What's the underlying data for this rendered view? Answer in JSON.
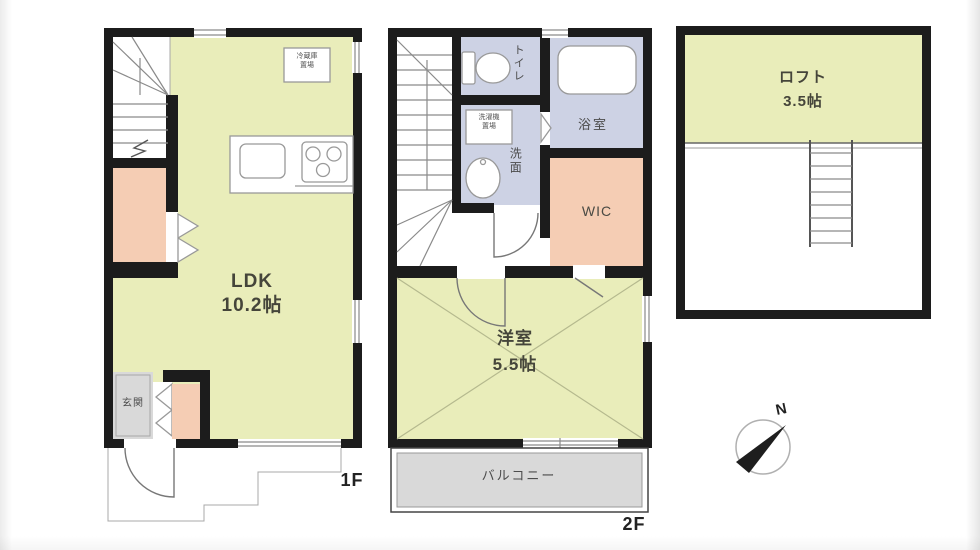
{
  "floor1": {
    "floor_label": "1F",
    "ldk_name": "LDK",
    "ldk_size": "10.2帖",
    "entrance_label": "玄関",
    "fridge_line1": "冷蔵庫",
    "fridge_line2": "置場"
  },
  "floor2": {
    "floor_label": "2F",
    "toilet_label": "トイレ",
    "bath_label": "浴室",
    "washroom_label": "洗面",
    "washer_line1": "洗濯機",
    "washer_line2": "置場",
    "wic_label": "WIC",
    "bedroom_name": "洋室",
    "bedroom_size": "5.5帖",
    "balcony_label": "バルコニー"
  },
  "loft": {
    "name": "ロフト",
    "size": "3.5帖"
  },
  "compass": {
    "north_label": "N"
  },
  "colors": {
    "wall": "#1c1c1c",
    "room_yellow": "#e9edba",
    "closet_pink": "#f5cdb4",
    "wet_lavender": "#cdd2e4",
    "entry_gray": "#d9d9d9",
    "line_gray": "#8a8a8a"
  }
}
